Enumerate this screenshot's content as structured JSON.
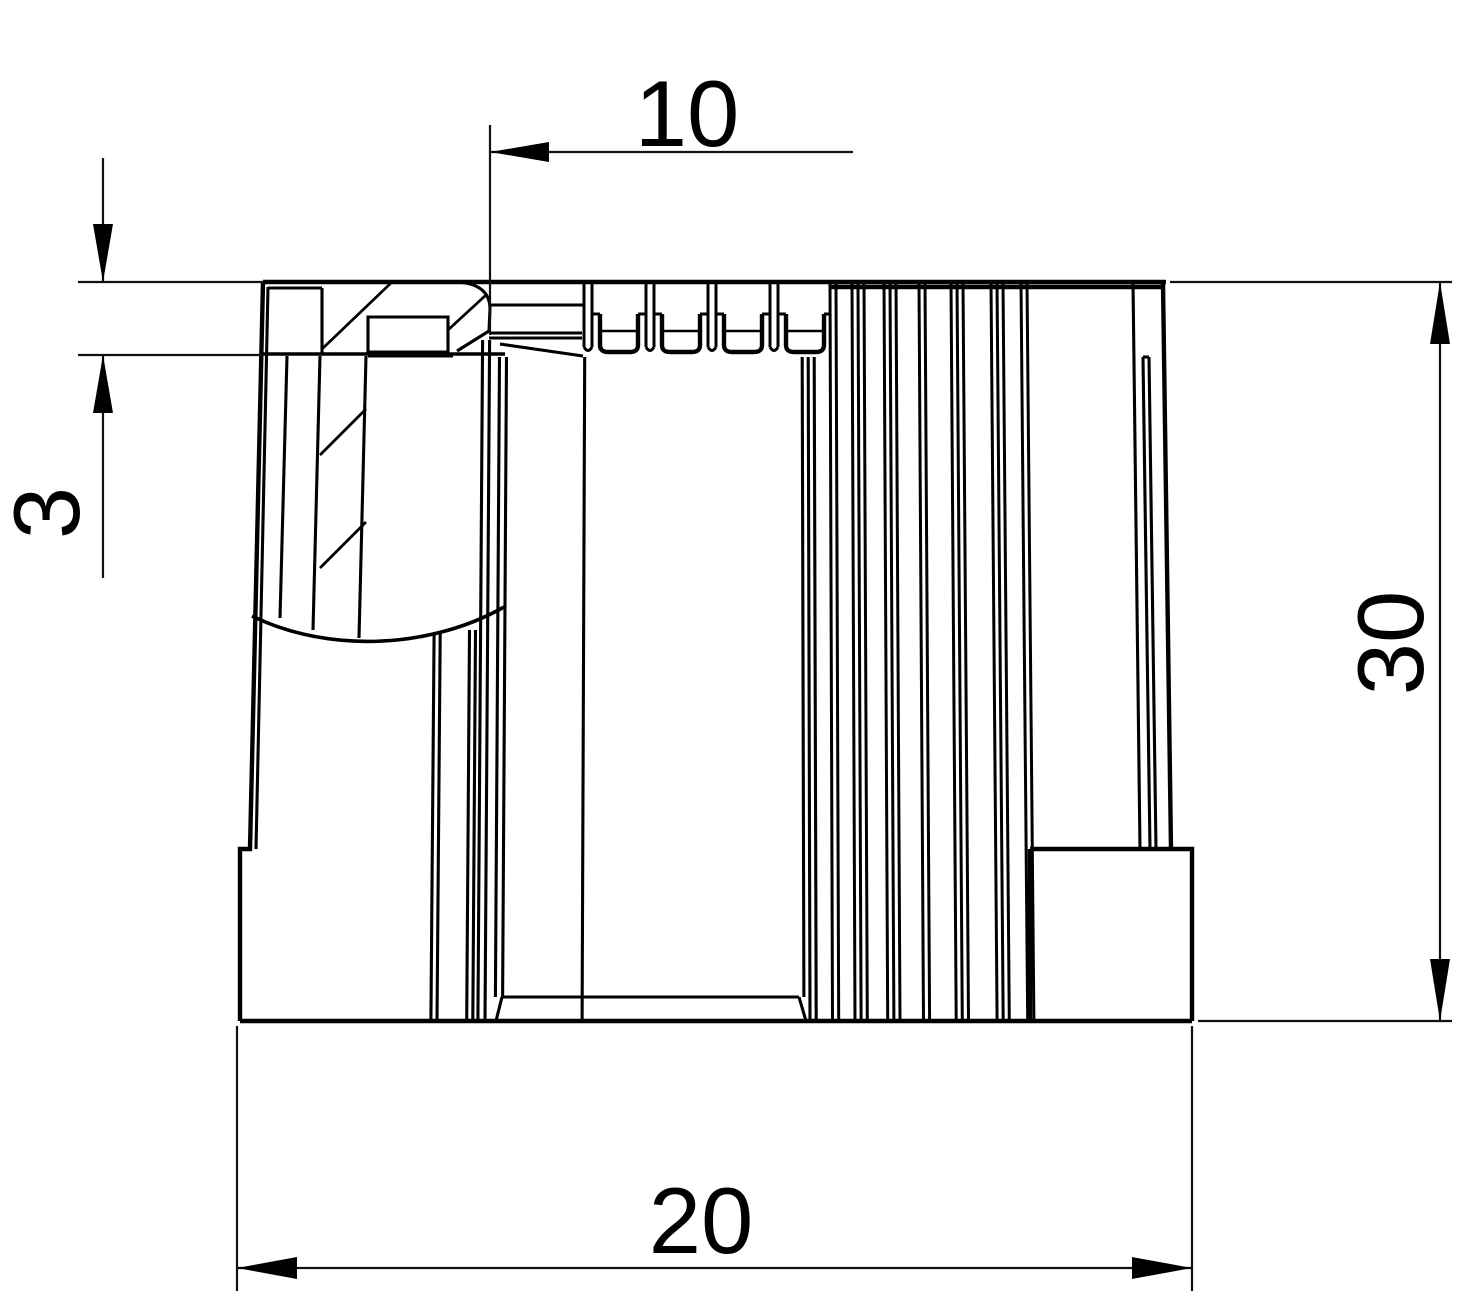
{
  "drawing": {
    "kind": "technical-dimension-drawing",
    "background_color": "#ffffff",
    "line_color": "#000000",
    "dimensions": [
      {
        "id": "rim-offset",
        "value": "10",
        "orientation": "horizontal",
        "position": "top"
      },
      {
        "id": "rim-thickness",
        "value": "3",
        "orientation": "vertical",
        "position": "left"
      },
      {
        "id": "overall-height",
        "value": "30",
        "orientation": "vertical",
        "position": "right"
      },
      {
        "id": "overall-width",
        "value": "20",
        "orientation": "horizontal",
        "position": "bottom"
      }
    ]
  }
}
